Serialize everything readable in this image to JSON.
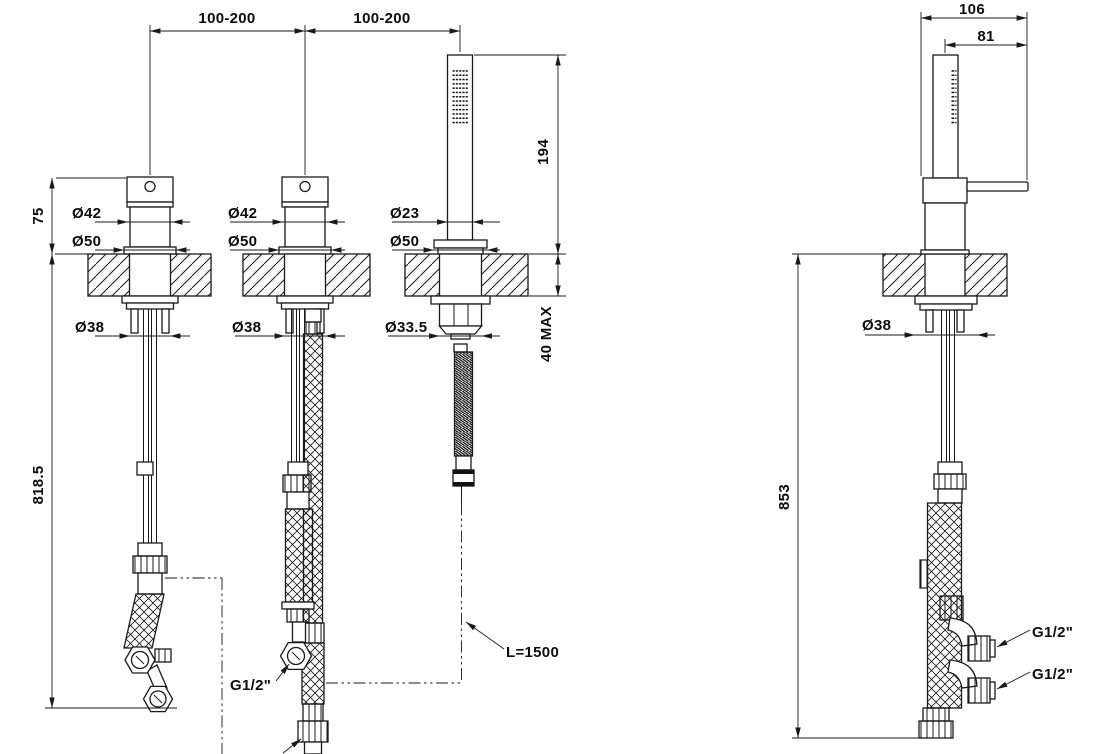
{
  "front": {
    "span_left": "100-200",
    "span_right": "100-200",
    "height_above_deck": "75",
    "depth_below": "818.5",
    "handshower_height": "194",
    "deck_thickness_max": "40  MAX",
    "valve1": {
      "top_diameter": "Ø42",
      "base_diameter": "Ø50",
      "under_diameter": "Ø38"
    },
    "valve2": {
      "top_diameter": "Ø42",
      "base_diameter": "Ø50",
      "under_diameter": "Ø38"
    },
    "handshower": {
      "wand_diameter": "Ø23",
      "base_diameter": "Ø50",
      "under_diameter": "Ø33.5"
    },
    "outlet_thread": "G1/2\"",
    "hose_length": "L=1500"
  },
  "side": {
    "total_width": "106",
    "lever_reach": "81",
    "depth_below": "853",
    "under_diameter": "Ø38",
    "inlet_top": "G1/2\"",
    "inlet_bottom": "G1/2\""
  }
}
